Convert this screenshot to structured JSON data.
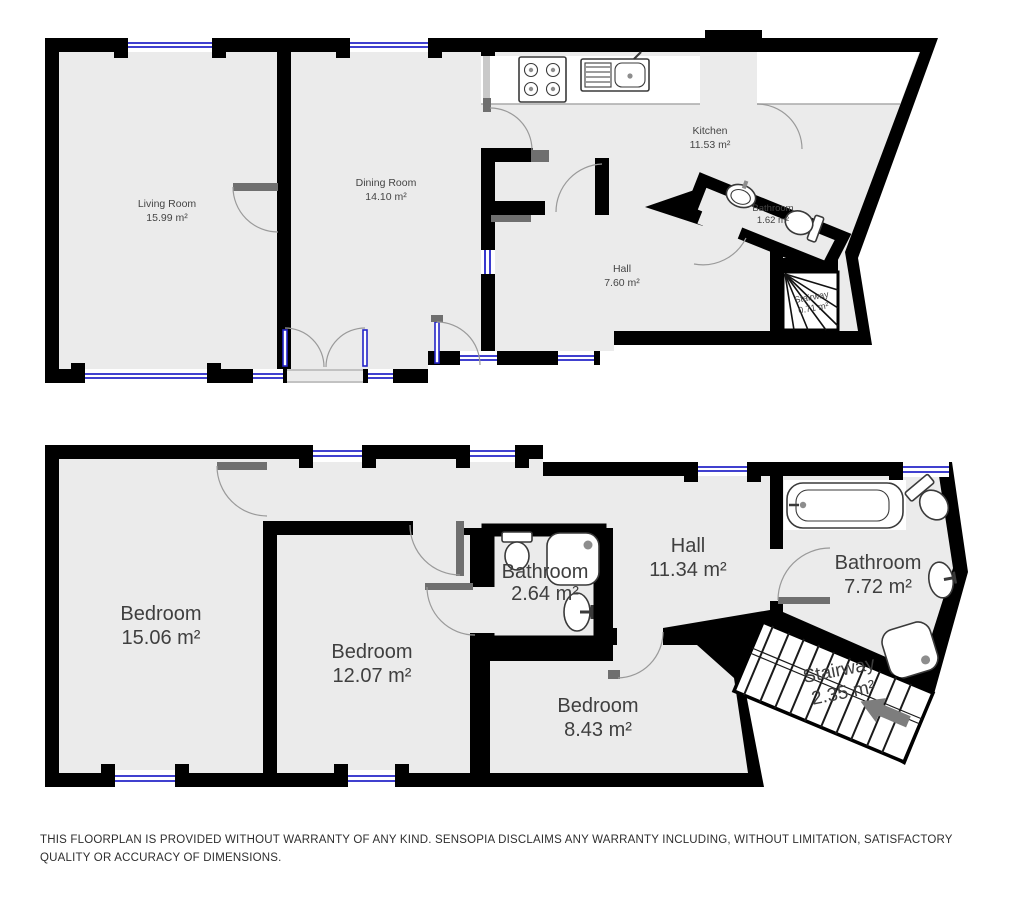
{
  "colors": {
    "wall": "#000000",
    "room": "#ebebeb",
    "win": "#2424c8",
    "arc": "#9a9a9a",
    "leaf": "#6f6f6f",
    "label": "#454545"
  },
  "floors": [
    {
      "label": "upper-floor",
      "rooms": [
        {
          "name": "Living Room",
          "area": "15.99 m²"
        },
        {
          "name": "Dining Room",
          "area": "14.10 m²"
        },
        {
          "name": "Kitchen",
          "area": "11.53 m²"
        },
        {
          "name": "Bathroom",
          "area": "1.62 m²"
        },
        {
          "name": "Hall",
          "area": "7.60 m²"
        },
        {
          "name": "Stairway",
          "area": "0.71 m²"
        }
      ]
    },
    {
      "label": "lower-floor",
      "rooms": [
        {
          "name": "Bedroom",
          "area": "15.06 m²"
        },
        {
          "name": "Bedroom",
          "area": "12.07 m²"
        },
        {
          "name": "Bathroom",
          "area": "2.64 m²"
        },
        {
          "name": "Hall",
          "area": "11.34 m²"
        },
        {
          "name": "Bathroom",
          "area": "7.72 m²"
        },
        {
          "name": "Bedroom",
          "area": "8.43 m²"
        },
        {
          "name": "Stairway",
          "area": "2.35 m²"
        }
      ]
    }
  ],
  "disclaimer": {
    "text": "THIS FLOORPLAN IS PROVIDED WITHOUT WARRANTY OF ANY KIND. SENSOPIA DISCLAIMS ANY WARRANTY INCLUDING, WITHOUT LIMITATION, SATISFACTORY QUALITY OR ACCURACY OF DIMENSIONS."
  }
}
